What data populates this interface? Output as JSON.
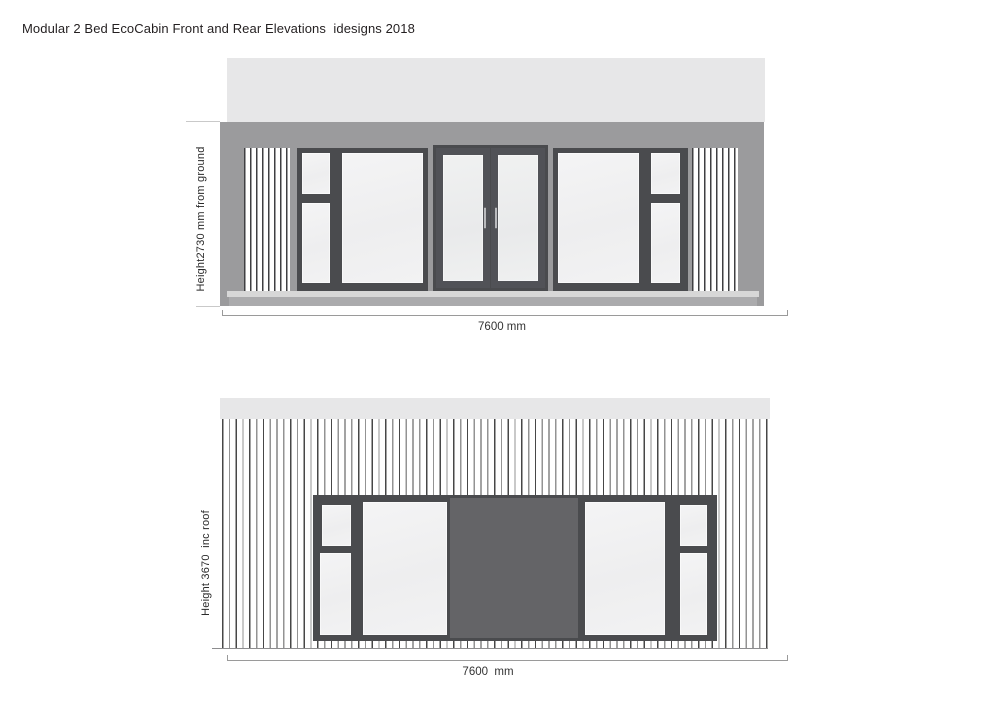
{
  "page": {
    "title": "Modular 2 Bed EcoCabin Front and Rear Elevations  idesigns 2018"
  },
  "front_elevation": {
    "name": "Front elevation",
    "height_label": "Height2730 mm from ground",
    "width_dimension": "7600 mm"
  },
  "rear_elevation": {
    "name": "Rear elevation",
    "height_label": "Height 3670  inc roof",
    "width_dimension": "7600  mm"
  },
  "colors": {
    "roof_band": "#e7e7e8",
    "wall": "#9b9b9d",
    "window_frame": "#4a4b4e",
    "glass": "#f1f1f2",
    "center_panel": "#646467",
    "sill_light": "#d7d7d7",
    "sill_mid": "#ababad",
    "dimension_line": "#9a9a9a",
    "text": "#2a2a2a"
  }
}
